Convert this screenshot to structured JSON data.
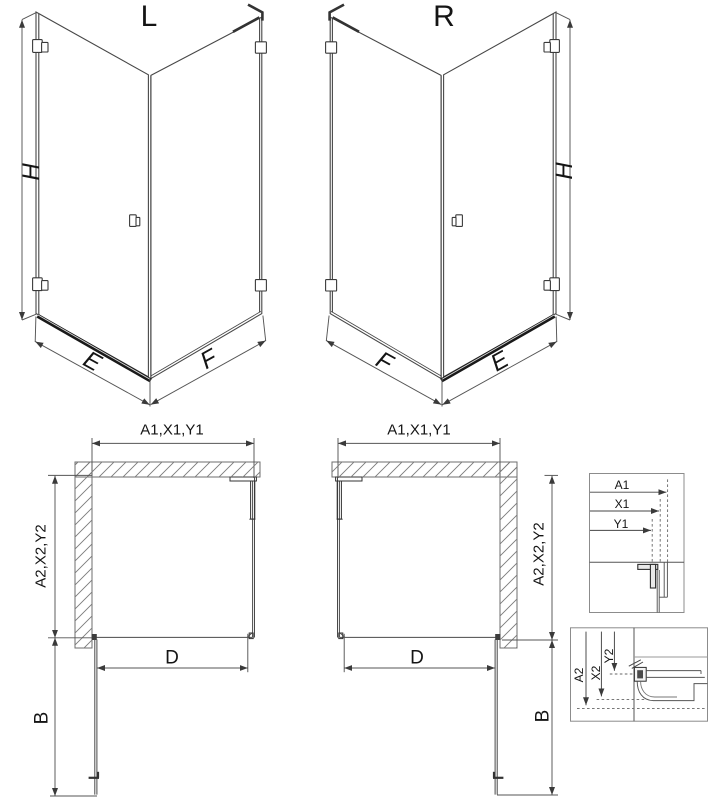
{
  "drawing": {
    "isometric_left": {
      "title": "L",
      "height": "H",
      "front_edge": "E",
      "side_edge": "F"
    },
    "isometric_right": {
      "title": "R",
      "height": "H",
      "front_edge": "E",
      "side_edge": "F"
    },
    "plan_left": {
      "width_dim": "A1,X1,Y1",
      "depth_dim": "A2,X2,Y2",
      "door_width": "D",
      "door_swing": "B"
    },
    "plan_right": {
      "width_dim": "A1,X1,Y1",
      "depth_dim": "A2,X2,Y2",
      "door_width": "D",
      "door_swing": "B"
    },
    "detail_width": {
      "dims": [
        "A1",
        "X1",
        "Y1"
      ]
    },
    "detail_depth": {
      "dims": [
        "A2",
        "X2",
        "Y2"
      ]
    }
  },
  "colors": {
    "line": "#474747",
    "dimension": "#555555",
    "threshold": "#191919",
    "hatch": "#7a7a7a",
    "box_border": "#8c8c8c",
    "text": "#141414"
  }
}
